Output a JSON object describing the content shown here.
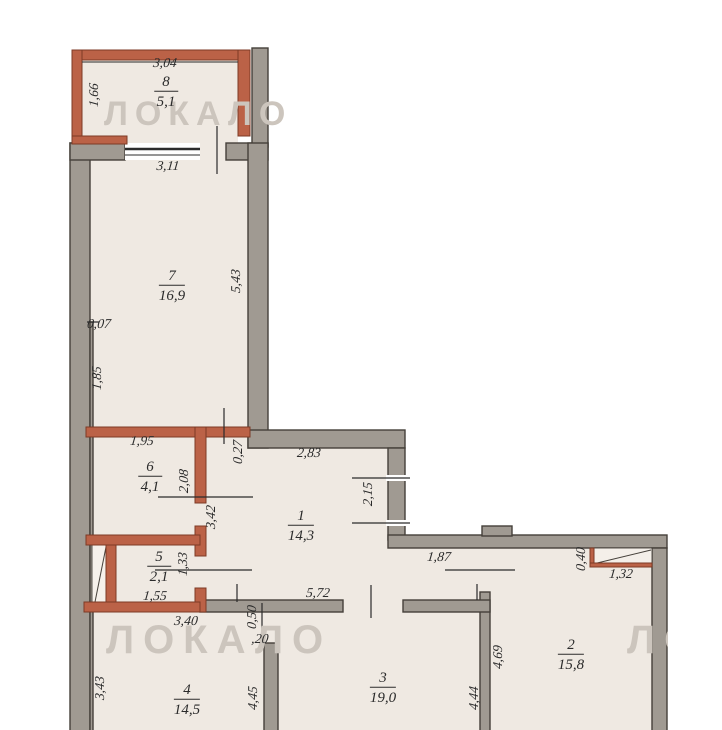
{
  "watermark": {
    "text": "ЛОКАЛО"
  },
  "colors": {
    "wallGray": "#a09a92",
    "inkDark": "#45403a",
    "wallRed": "#bb6247",
    "redDark": "#7c3a26",
    "floor": "#efe9e2",
    "ink": "#2b2b2b",
    "watermark": "#ccc5bd"
  },
  "rooms": {
    "r1": {
      "num": "1",
      "area": "14,3"
    },
    "r2": {
      "num": "2",
      "area": "15,8"
    },
    "r3": {
      "num": "3",
      "area": "19,0"
    },
    "r4": {
      "num": "4",
      "area": "14,5"
    },
    "r5": {
      "num": "5",
      "area": "2,1"
    },
    "r6": {
      "num": "6",
      "area": "4,1"
    },
    "r7": {
      "num": "7",
      "area": "16,9"
    },
    "r8": {
      "num": "8",
      "area": "5,1"
    }
  },
  "dims": {
    "balcony_top": "3,04",
    "balcony_side": "1,66",
    "r7_top": "3,11",
    "r7_side": "5,43",
    "wall_offset": "0,07",
    "r7_side_lower": "1,85",
    "r6_top": "1,95",
    "r6_side": "2,08",
    "step_027": "0,27",
    "r1_top": "2,83",
    "r1_side": "2,15",
    "corridor_side": "3,42",
    "r5_side": "1,33",
    "r5_bottom": "1,55",
    "hall_width": "1,87",
    "hall_bottom": "5,72",
    "closet_side": "0,40",
    "closet_bottom": "1,32",
    "r4_top": "3,40",
    "stub_050": "0,50",
    "wall_020": ",20",
    "r4_side": "3,43",
    "r4_right": "4,45",
    "r2_side": "4,69",
    "r3_side": "4,44"
  }
}
